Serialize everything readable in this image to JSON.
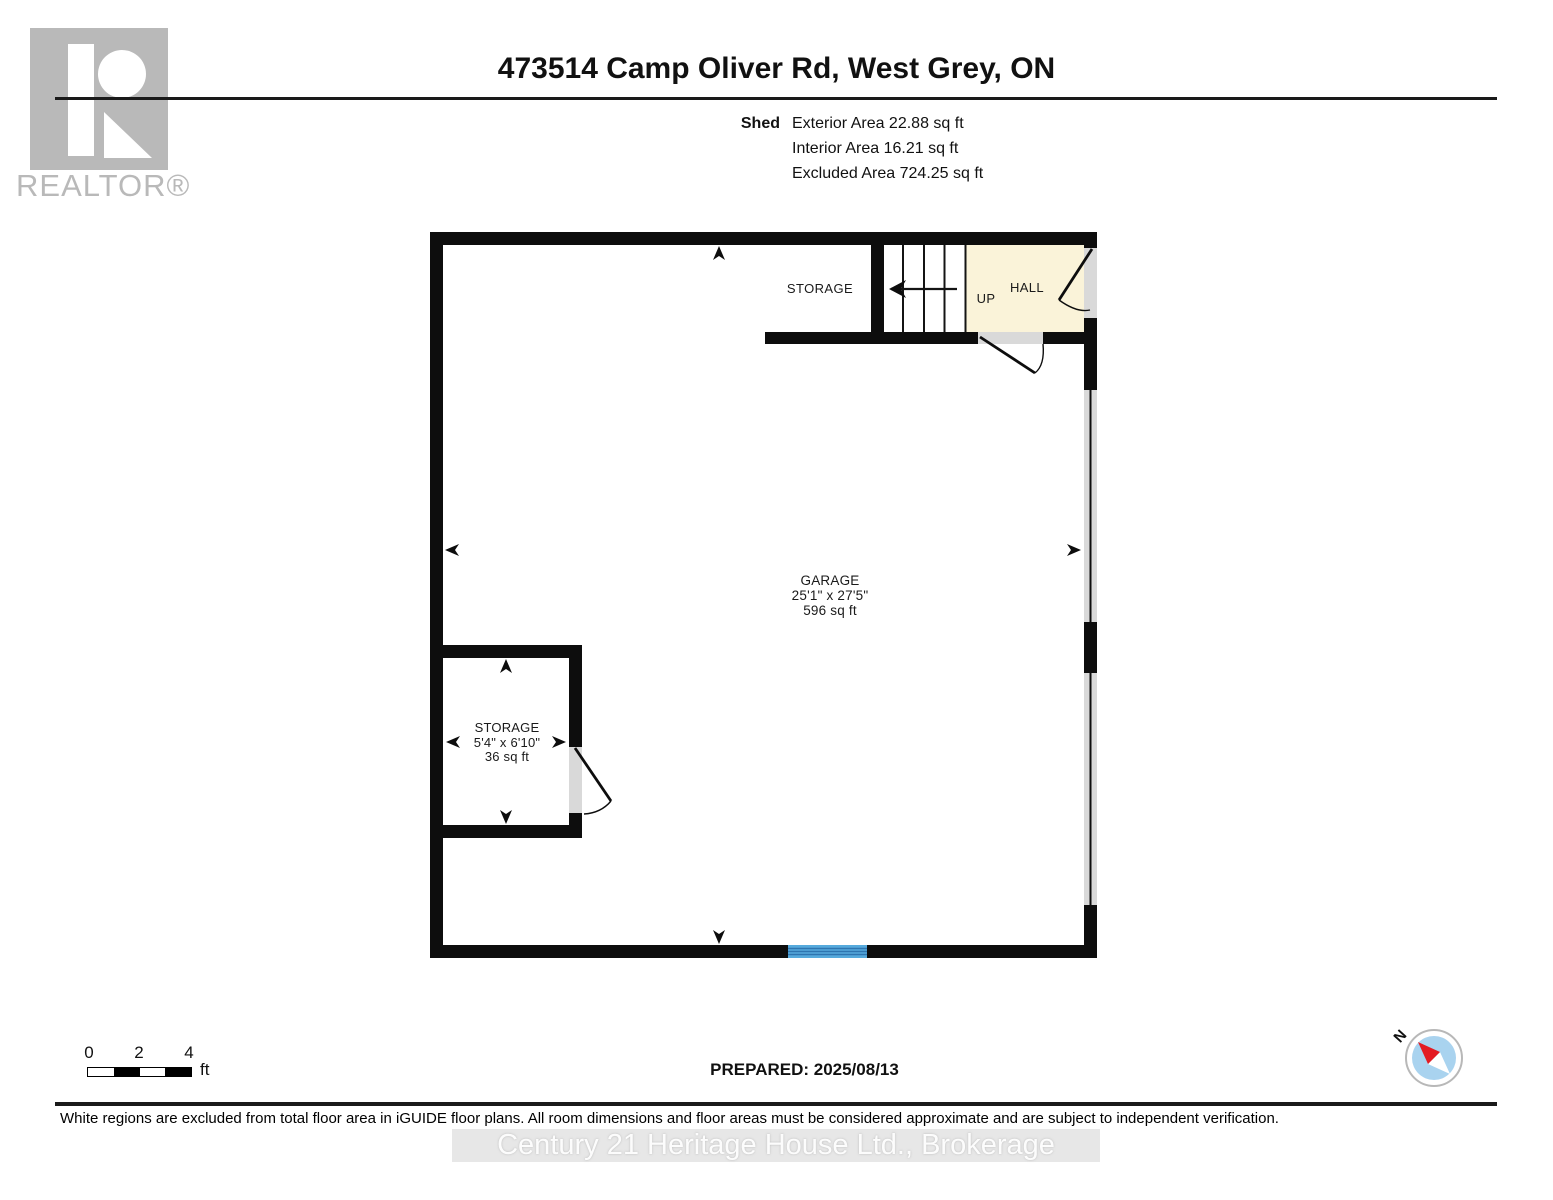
{
  "header": {
    "logo_text": "REALTOR®",
    "title": "473514 Camp Oliver Rd, West Grey, ON"
  },
  "summary": {
    "floor_label": "Shed",
    "rows": [
      "Exterior Area 22.88 sq ft",
      "Interior Area 16.21 sq ft",
      "Excluded Area 724.25 sq ft"
    ]
  },
  "plan": {
    "rooms": {
      "storage_top": {
        "name": "STORAGE"
      },
      "hall": {
        "name": "HALL"
      },
      "stairs": {
        "direction_label": "UP"
      },
      "garage": {
        "name": "GARAGE",
        "dimensions": "25'1\" x 27'5\"",
        "area": "596 sq ft"
      },
      "storage_small": {
        "name": "STORAGE",
        "dimensions": "5'4\" x 6'10\"",
        "area": "36 sq ft"
      }
    },
    "colors": {
      "wall": "#0d0d0d",
      "hall_fill": "#faf3d9",
      "opening": "#d9d9d9",
      "garage_door_fill": "#56aadc",
      "garage_door_stripe": "#2e75b0"
    }
  },
  "scale_bar": {
    "ticks": [
      "0",
      "2",
      "4"
    ],
    "unit": "ft"
  },
  "prepared_label": "PREPARED: 2025/08/13",
  "compass": {
    "north_label": "N",
    "needle_color": "#e31b23",
    "disc_color": "#a9d3ef",
    "ring_color": "#b8b8b8"
  },
  "footer": {
    "disclaimer": "White regions are excluded from total floor area in iGUIDE floor plans. All room dimensions and floor areas must be considered approximate and are subject to independent verification.",
    "watermark": "Century 21 Heritage House Ltd.,  Brokerage"
  }
}
